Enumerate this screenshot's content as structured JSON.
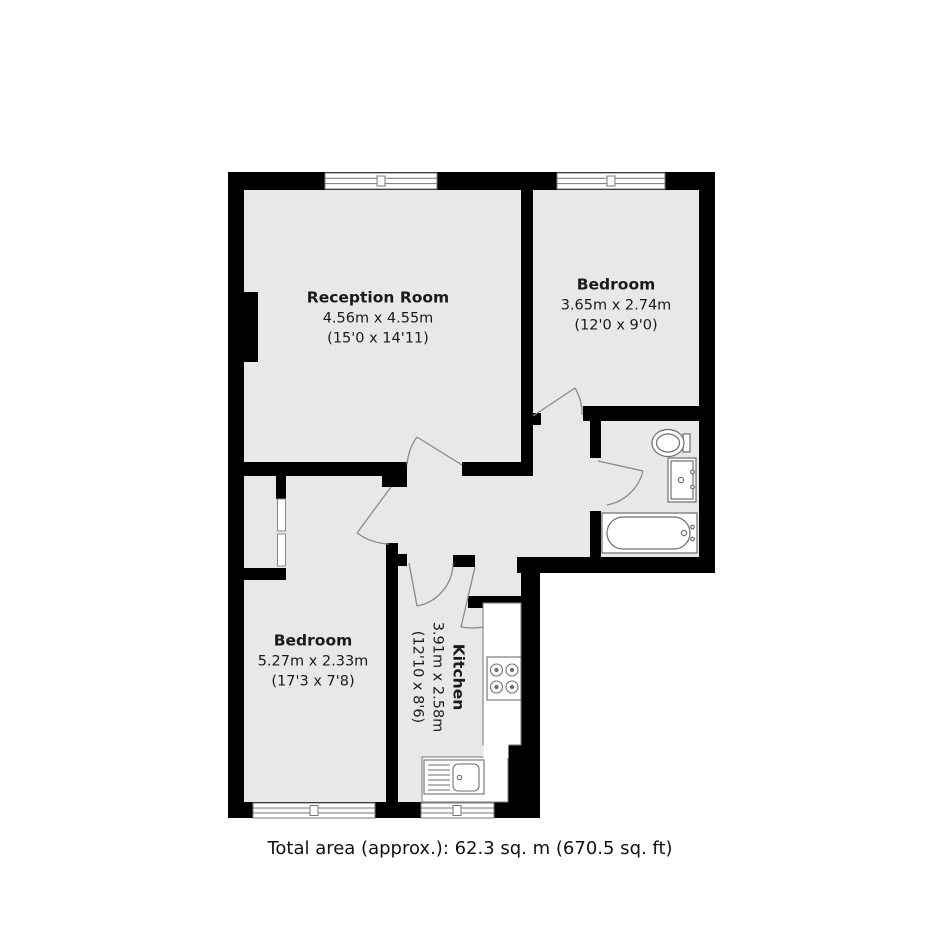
{
  "plan": {
    "type": "residential-floorplan",
    "rooms": {
      "reception": {
        "name": "Reception Room",
        "size_metric": "4.56m x 4.55m",
        "size_imperial": "(15'0 x 14'11)"
      },
      "bedroom_top": {
        "name": "Bedroom",
        "size_metric": "3.65m x 2.74m",
        "size_imperial": "(12'0 x 9'0)"
      },
      "bedroom_bottom": {
        "name": "Bedroom",
        "size_metric": "5.27m x 2.33m",
        "size_imperial": "(17'3 x 7'8)"
      },
      "kitchen": {
        "name": "Kitchen",
        "size_metric": "3.91m x 2.58m",
        "size_imperial": "(12'10 x 8'6)"
      }
    },
    "fixtures": [
      "toilet",
      "washbasin",
      "bathtub",
      "hob-4-burners",
      "sink-with-drainer",
      "built-in-cupboard",
      "windows",
      "door-swings"
    ],
    "colors": {
      "floor": "#e8e8e8",
      "wall": "#000000",
      "fixture_line": "#6e6e6e",
      "door_arc": "#8a8a8a",
      "text": "#1a1a1a"
    }
  },
  "footer": {
    "total_area": "Total area (approx.): 62.3 sq. m (670.5 sq. ft)"
  }
}
